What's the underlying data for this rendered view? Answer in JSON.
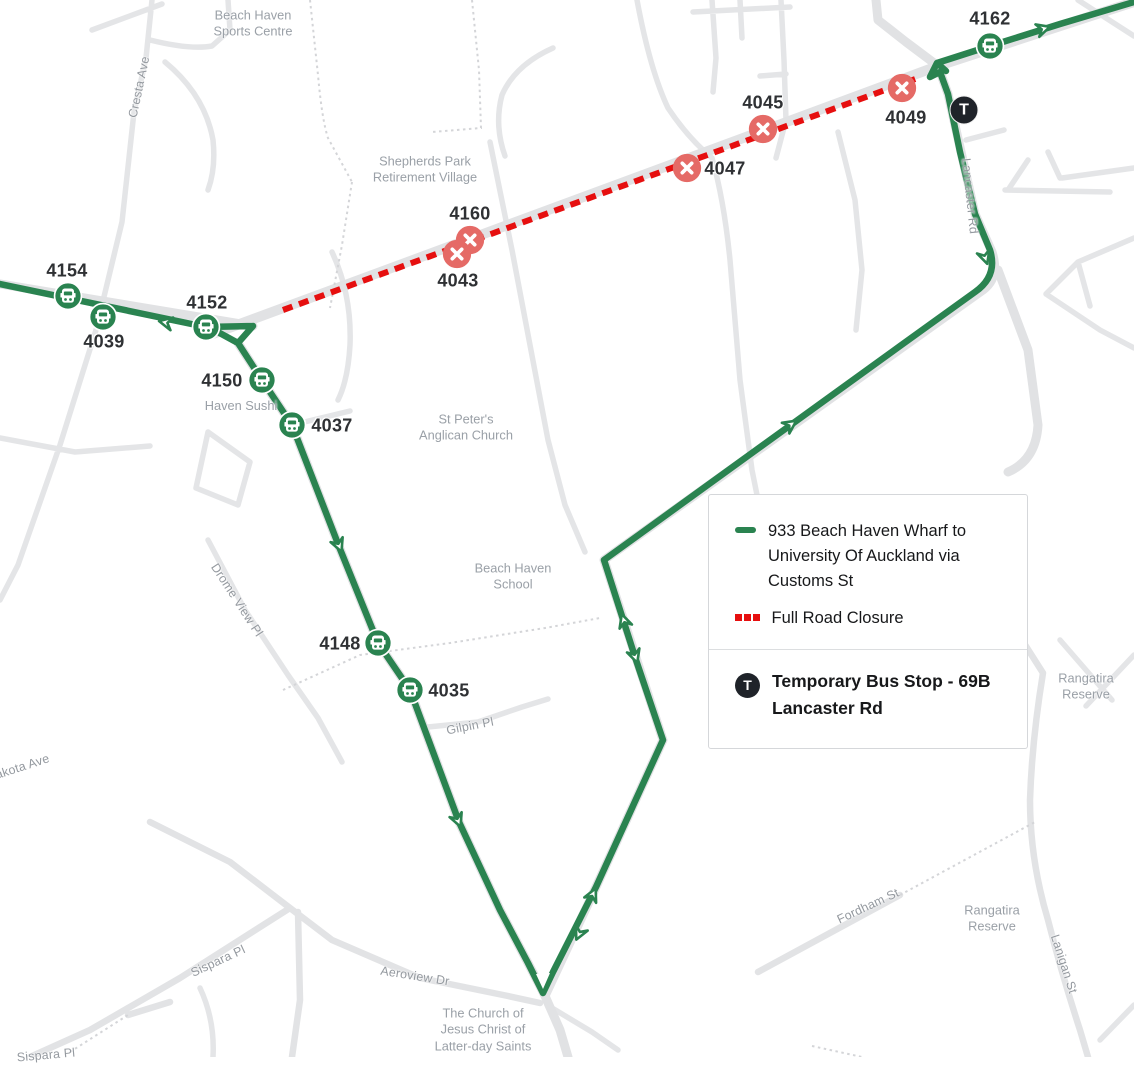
{
  "map": {
    "route_color": "#2a8350",
    "closure_color": "#e60f0f",
    "stops_open": [
      {
        "label": "4154"
      },
      {
        "label": "4039"
      },
      {
        "label": "4152"
      },
      {
        "label": "4150"
      },
      {
        "label": "4037"
      },
      {
        "label": "4148"
      },
      {
        "label": "4035"
      },
      {
        "label": "4162"
      }
    ],
    "stops_closed": [
      {
        "label": "4160"
      },
      {
        "label": "4043"
      },
      {
        "label": "4047"
      },
      {
        "label": "4045"
      },
      {
        "label": "4049"
      }
    ],
    "temporary_stop": {
      "letter": "T"
    },
    "places": [
      {
        "text": "Beach Haven\nSports Centre"
      },
      {
        "text": "Shepherds Park\nRetirement Village"
      },
      {
        "text": "St Peter's\nAnglican Church"
      },
      {
        "text": "Haven Sushi"
      },
      {
        "text": "Beach Haven\nSchool"
      },
      {
        "text": "The Church of\nJesus Christ of\nLatter-day Saints"
      },
      {
        "text": "Rangatira\nReserve"
      },
      {
        "text": "Rangatira\nReserve"
      }
    ],
    "streets": [
      {
        "text": "Cresta Ave"
      },
      {
        "text": "Drome View Pl"
      },
      {
        "text": "Dakota Ave"
      },
      {
        "text": "Gilpin Pl"
      },
      {
        "text": "Sispara Pl"
      },
      {
        "text": "Aeroview Dr"
      },
      {
        "text": "Fordham St"
      },
      {
        "text": "Lanigan St"
      },
      {
        "text": "Lancaster Rd"
      },
      {
        "text": "Sispara Pl"
      }
    ]
  },
  "legend": {
    "route_label": "933 Beach Haven Wharf to University Of Auckland via Customs St",
    "closure_label": "Full Road Closure",
    "temporary_label": "Temporary Bus Stop - 69B Lancaster Rd",
    "t_letter": "T"
  }
}
